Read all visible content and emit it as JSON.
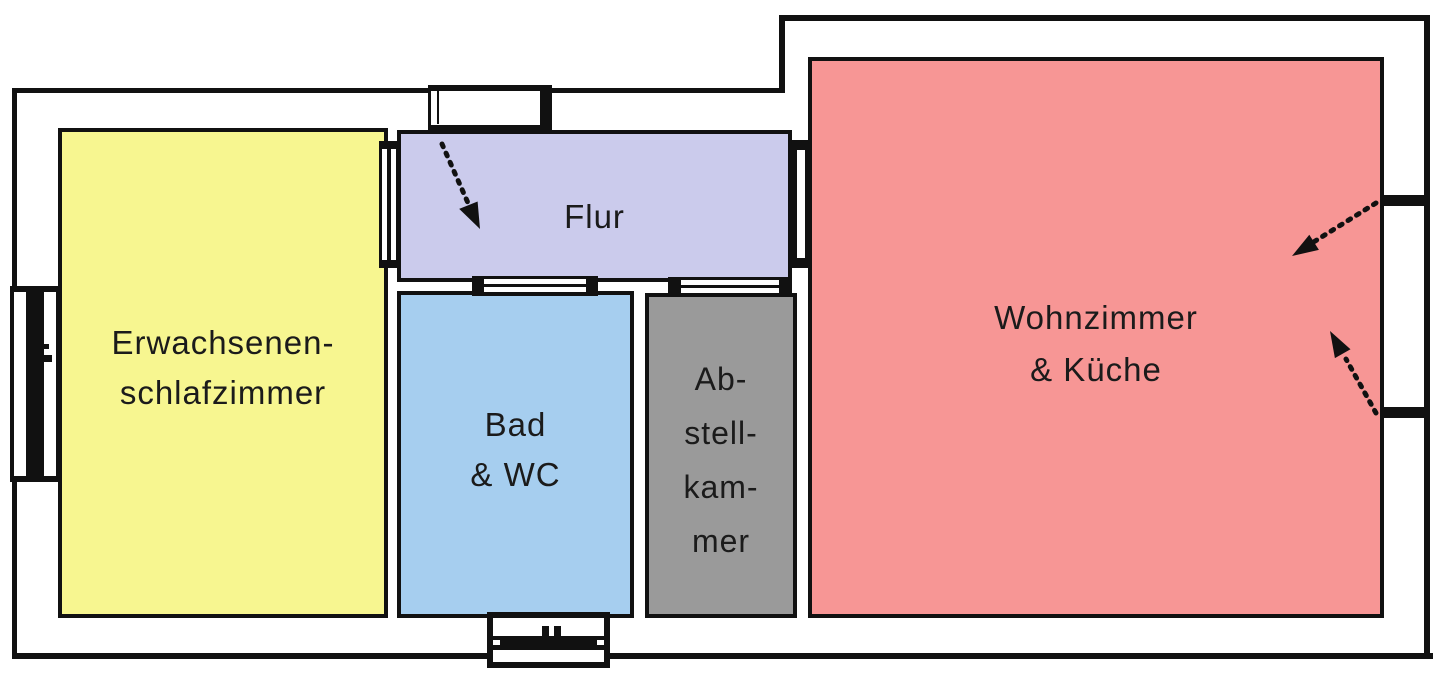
{
  "plan": {
    "type": "apartment-floor-plan",
    "background_color": "#FFFFFF",
    "wall_color": "#111111",
    "text_color": "#1B1B1B"
  },
  "rooms": {
    "bedroom": {
      "label": "Erwachsenen-schlafzimmer",
      "lines": [
        "Erwachsenen-",
        "schlafzimmer"
      ],
      "color": "#F7F690"
    },
    "hallway": {
      "label": "Flur",
      "lines": [
        "Flur"
      ],
      "color": "#CBCBEC"
    },
    "bathroom": {
      "label": "Bad & WC",
      "lines": [
        "Bad",
        "& WC"
      ],
      "color": "#A6CEEF"
    },
    "storage": {
      "label": "Abstellkammer",
      "lines": [
        "Ab-",
        "stell-",
        "kam-",
        "mer"
      ],
      "color": "#9A9A9A"
    },
    "living": {
      "label": "Wohnzimmer & Küche",
      "lines": [
        "Wohnzimmer",
        "& Küche"
      ],
      "color": "#F79695"
    }
  },
  "symbols": {
    "windows": [
      "window-left-wall",
      "window-bottom-bathroom"
    ],
    "doors": [
      "entrance-door-top",
      "door-bedroom-hallway",
      "door-hallway-living",
      "door-hallway-bathroom",
      "door-hallway-storage"
    ],
    "arrows": [
      "entrance-swing-arrow",
      "living-upper-swing-arrow",
      "living-lower-swing-arrow"
    ]
  }
}
